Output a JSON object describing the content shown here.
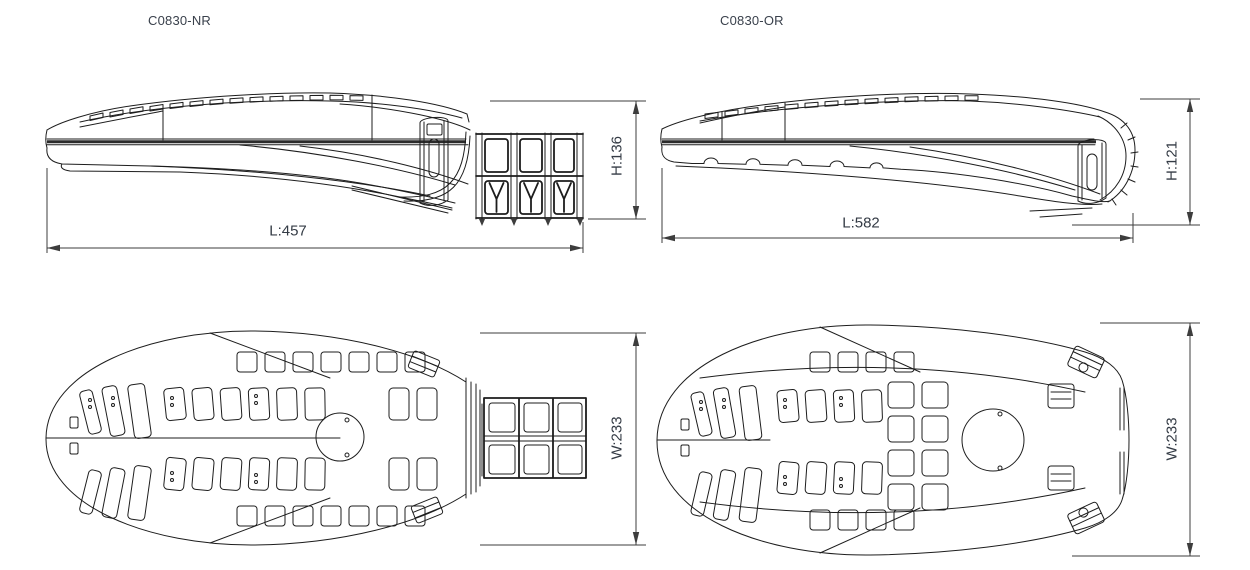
{
  "page": {
    "background": "#ffffff"
  },
  "colors": {
    "drawing_line": "#1d1d1d",
    "dimension_line": "#3d3d3d",
    "label_text": "#3a414c"
  },
  "drawings": {
    "nr": {
      "name": "C0830-NR",
      "side_view": {
        "length": "L:457",
        "height": "H:136"
      },
      "top_view": {
        "width": "W:233"
      }
    },
    "or": {
      "name": "C0830-OR",
      "side_view": {
        "length": "L:582",
        "height": "H:121"
      },
      "top_view": {
        "width": "W:233"
      }
    }
  }
}
